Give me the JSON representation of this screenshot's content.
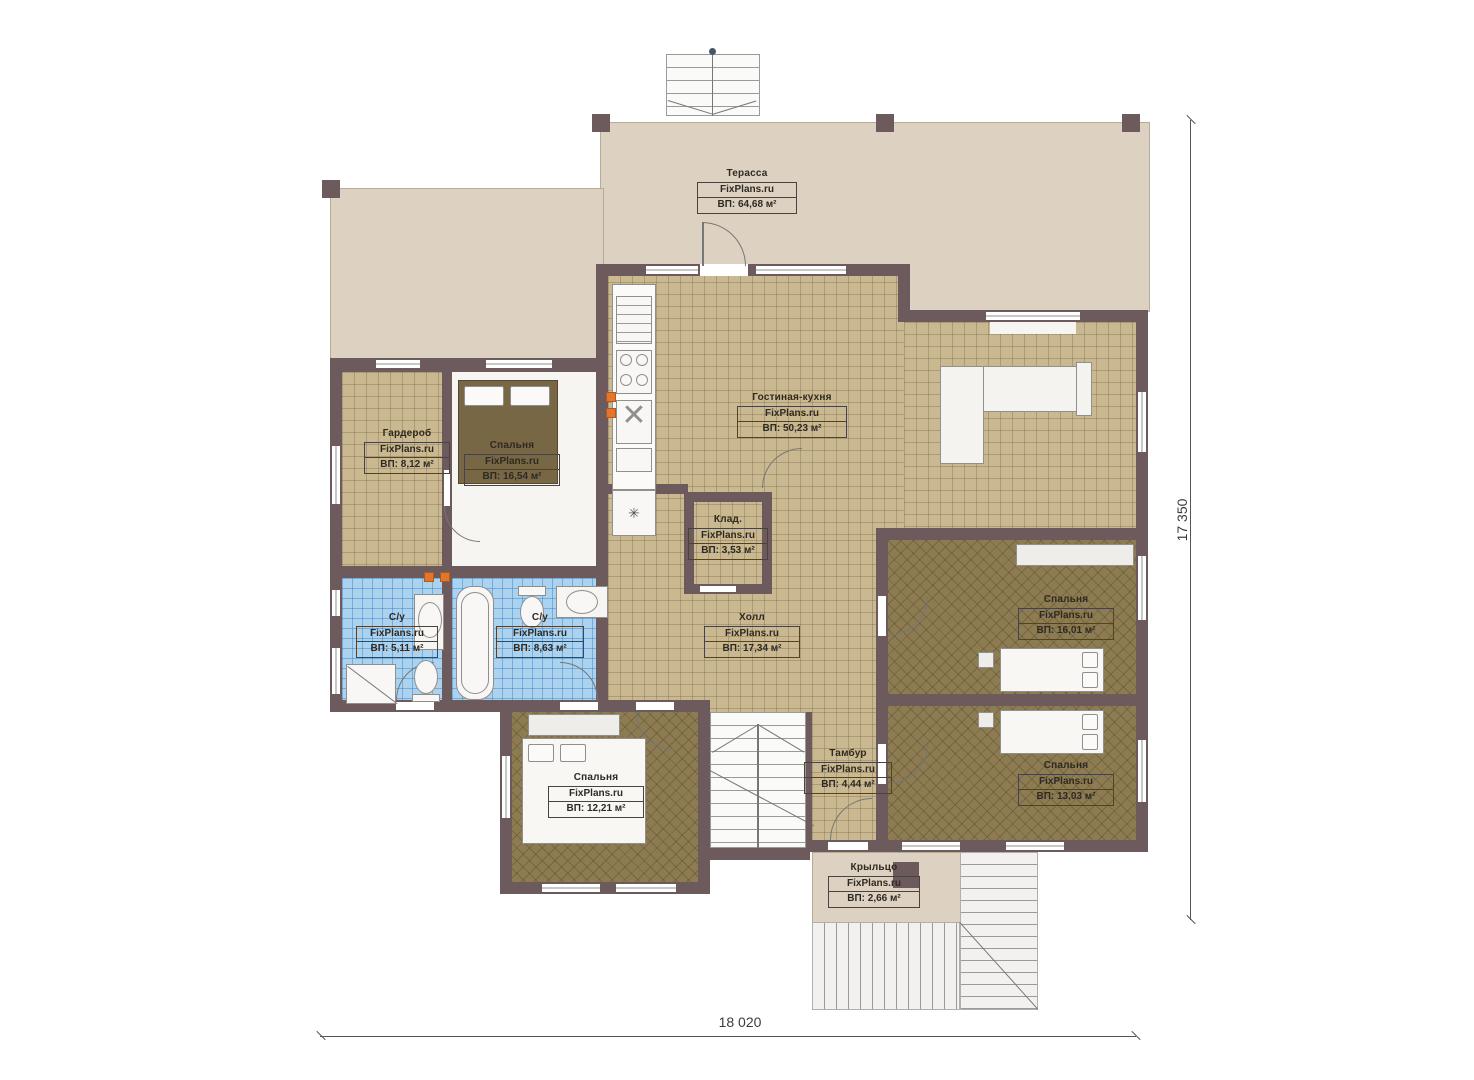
{
  "branding": {
    "site": "FixPlans.ru"
  },
  "plan": {
    "type": "floor-plan",
    "units": "м²",
    "overall_width_mm": "18 020",
    "overall_height_mm": "17 350"
  },
  "dimensions": {
    "bottom_label": "18 020",
    "right_label": "17 350"
  },
  "rooms": [
    {
      "id": "terrace",
      "name": "Терасса",
      "site": "FixPlans.ru",
      "area": "ВП: 64,68 м²"
    },
    {
      "id": "living",
      "name": "Гостиная-кухня",
      "site": "FixPlans.ru",
      "area": "ВП: 50,23 м²"
    },
    {
      "id": "wardrobe",
      "name": "Гардероб",
      "site": "FixPlans.ru",
      "area": "ВП: 8,12 м²"
    },
    {
      "id": "bedroom1",
      "name": "Спальня",
      "site": "FixPlans.ru",
      "area": "ВП: 16,54 м²"
    },
    {
      "id": "storage",
      "name": "Клад.",
      "site": "FixPlans.ru",
      "area": "ВП: 3,53 м²"
    },
    {
      "id": "hall",
      "name": "Холл",
      "site": "FixPlans.ru",
      "area": "ВП: 17,34 м²"
    },
    {
      "id": "bath1",
      "name": "С/у",
      "site": "FixPlans.ru",
      "area": "ВП: 5,11 м²"
    },
    {
      "id": "bath2",
      "name": "С/у",
      "site": "FixPlans.ru",
      "area": "ВП: 8,63 м²"
    },
    {
      "id": "bedroom2",
      "name": "Спальня",
      "site": "FixPlans.ru",
      "area": "ВП: 16,01 м²"
    },
    {
      "id": "bedroom3",
      "name": "Спальня",
      "site": "FixPlans.ru",
      "area": "ВП: 12,21 м²"
    },
    {
      "id": "bedroom4",
      "name": "Спальня",
      "site": "FixPlans.ru",
      "area": "ВП: 13,03 м²"
    },
    {
      "id": "tambour",
      "name": "Тамбур",
      "site": "FixPlans.ru",
      "area": "ВП: 4,44 м²"
    },
    {
      "id": "porch",
      "name": "Крыльцо",
      "site": "FixPlans.ru",
      "area": "ВП: 2,66 м²"
    }
  ],
  "colors": {
    "wall": "#6d5a5c",
    "terrace": "#ddd2c1",
    "tan_tile": "#c9b890",
    "blue_tile": "#abd2ee",
    "brown_floor": "#8d7c52",
    "accent_orange": "#e2762d"
  }
}
